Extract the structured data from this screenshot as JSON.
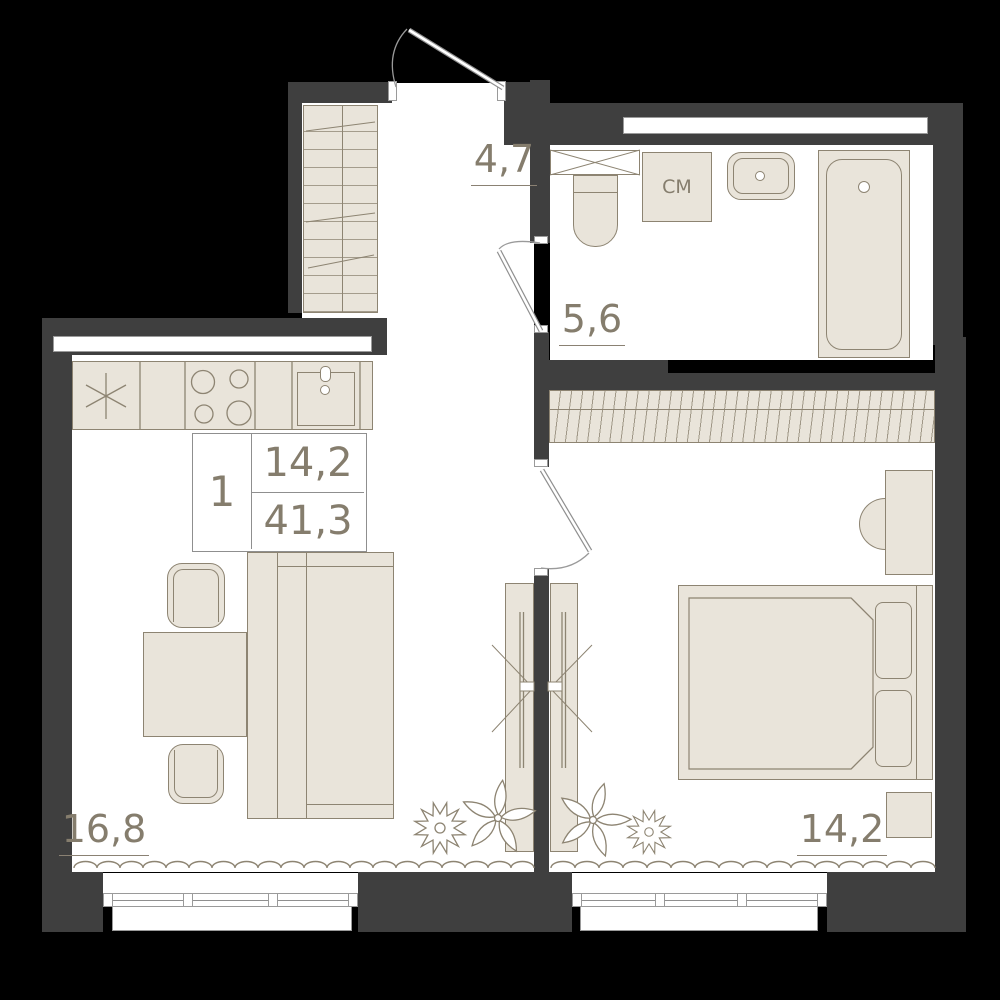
{
  "plan": {
    "title": "1-room apartment floor plan",
    "labels": {
      "hallway_area": "4,7",
      "bathroom_area": "5,6",
      "living_kitchen_area": "16,8",
      "bedroom_area": "14,2"
    },
    "info_plate": {
      "rooms_count": "1",
      "living_area": "14,2",
      "total_area": "41,3"
    },
    "appliances": {
      "washing_machine_label": "СМ"
    },
    "colors": {
      "background": "#000000",
      "wall": "#3f3f3f",
      "floor": "#ffffff",
      "furniture_fill": "#e9e4da",
      "outline": "#8d8472",
      "label_text": "#857d6d"
    }
  }
}
